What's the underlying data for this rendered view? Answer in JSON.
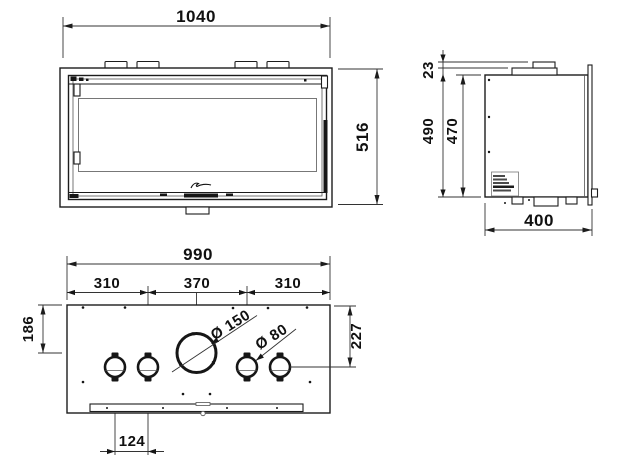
{
  "dims": {
    "front_width": "1040",
    "front_height": "516",
    "side_flue_offset": "23",
    "side_height_overall": "490",
    "side_height_body": "470",
    "side_depth": "400",
    "plan_width": "990",
    "plan_left": "310",
    "plan_center": "370",
    "plan_right": "310",
    "plan_depth_left": "186",
    "plan_depth_right": "227",
    "flue_diameter": "Ø 150",
    "duct_diameter": "Ø 80",
    "duct_spacing": "124"
  }
}
